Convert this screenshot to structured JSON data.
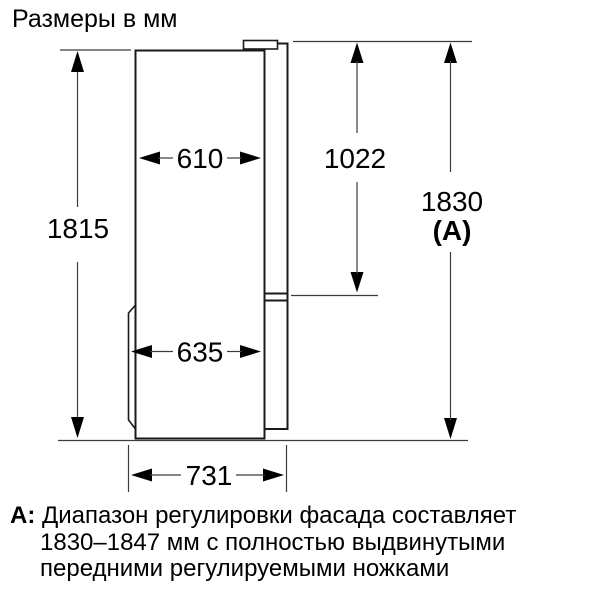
{
  "title": "Размеры в мм",
  "diagram": {
    "subject": "refrigerator-side-view-dimension-drawing",
    "units": "мм",
    "dims": {
      "cabinet_height": "1815",
      "cabinet_depth": "610",
      "upper_door_height": "1022",
      "total_height": "1830",
      "total_height_key": "(A)",
      "lower_depth": "635",
      "total_depth": "731"
    }
  },
  "footnote": {
    "key": "A:",
    "lines": [
      "Диапазон регулировки фасада составляет",
      "1830–1847 мм с полностью выдвинутыми",
      "передними регулируемыми ножками"
    ]
  },
  "colors": {
    "line": "#1a1a1a",
    "dim_line": "#3c3c3c",
    "text": "#000000",
    "background": "#ffffff"
  }
}
